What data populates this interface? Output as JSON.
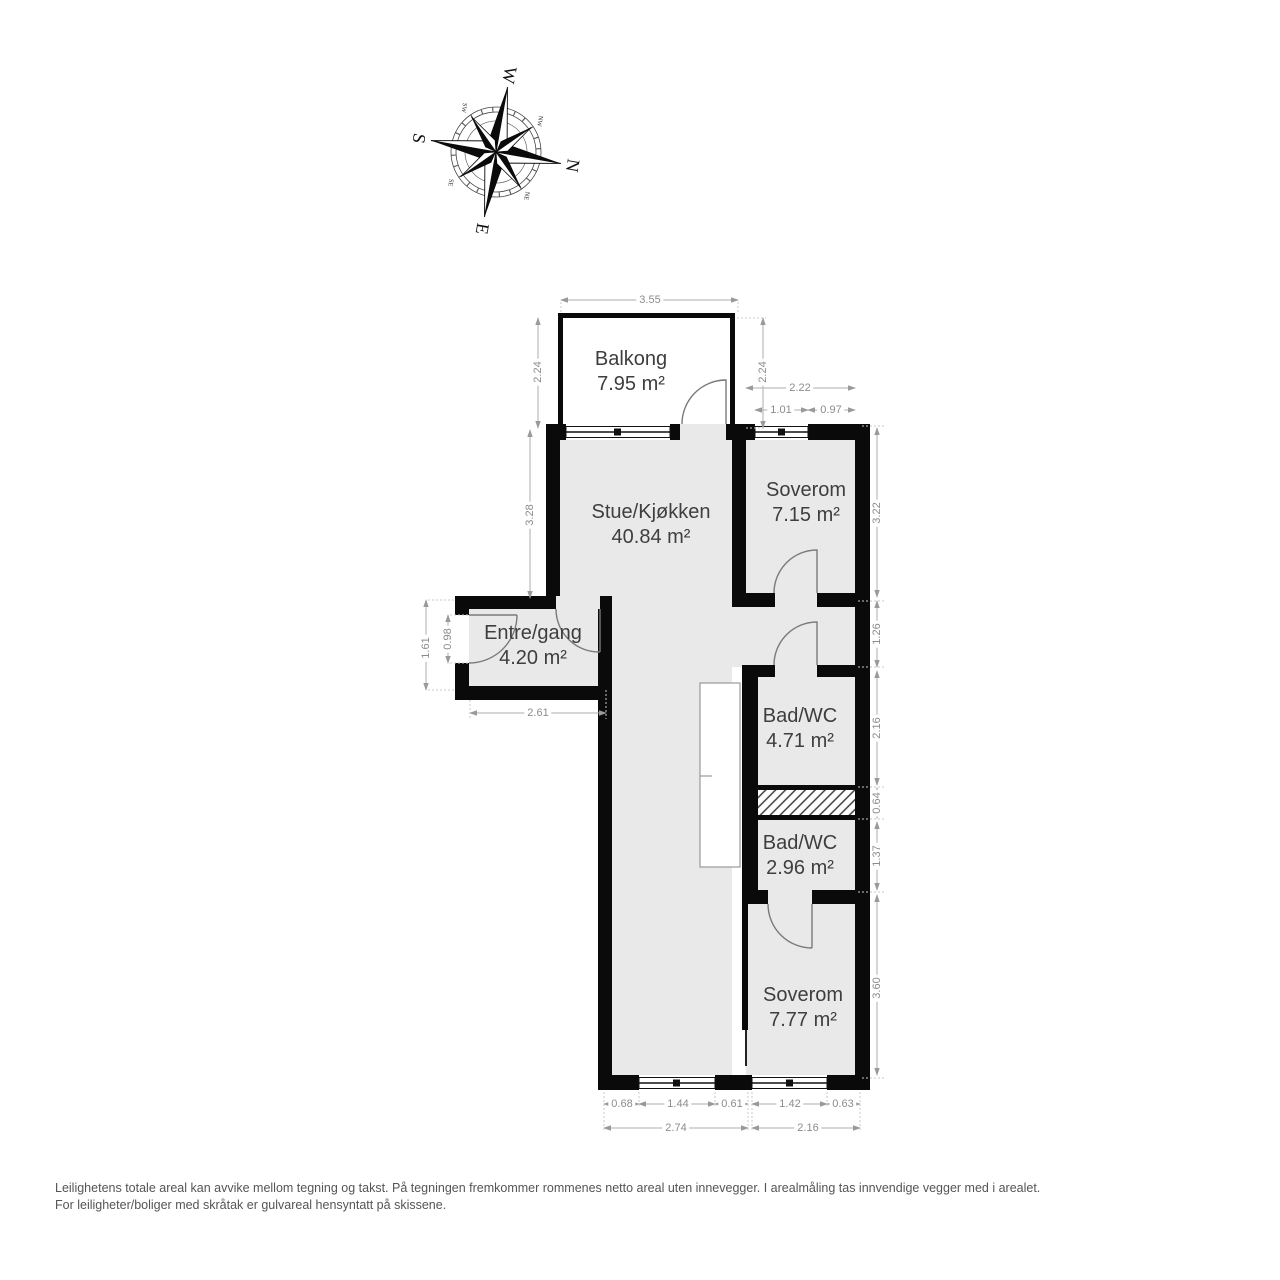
{
  "compass": {
    "n": "N",
    "e": "E",
    "s": "S",
    "w": "W",
    "ne": "NE",
    "se": "SE",
    "sw": "SW",
    "nw": "NW"
  },
  "rooms": {
    "balcony": {
      "name": "Balkong",
      "area": "7.95 m²"
    },
    "living": {
      "name": "Stue/Kjøkken",
      "area": "40.84 m²"
    },
    "bedroom1": {
      "name": "Soverom",
      "area": "7.15 m²"
    },
    "entre": {
      "name": "Entre/gang",
      "area": "4.20 m²"
    },
    "bath1": {
      "name": "Bad/WC",
      "area": "4.71 m²"
    },
    "bath2": {
      "name": "Bad/WC",
      "area": "2.96 m²"
    },
    "bedroom2": {
      "name": "Soverom",
      "area": "7.77 m²"
    }
  },
  "dims": {
    "balcony_width": "3.55",
    "balcony_depth_left": "2.24",
    "balcony_depth_right": "2.24",
    "bedroom1_width": "2.22",
    "bedroom1_window": "1.01",
    "bedroom1_wall": "0.97",
    "living_left_height": "3.28",
    "bedroom1_depth": "3.22",
    "hall_depth": "1.26",
    "bath1_depth": "2.16",
    "shaft_depth": "0.64",
    "bath2_depth": "1.37",
    "bedroom2_depth": "3.60",
    "entre_outer_left": "1.61",
    "entre_door": "0.98",
    "entre_width": "2.61",
    "bottom_seg1": "0.68",
    "bottom_seg2": "1.44",
    "bottom_seg3": "0.61",
    "bottom_seg4": "1.42",
    "bottom_seg5": "0.63",
    "bottom_total_left": "2.74",
    "bottom_total_right": "2.16"
  },
  "colors": {
    "floor": "#e9e9e9",
    "wall": "#000000",
    "dim_text": "#8c8c8c",
    "room_text": "#3e3e3e"
  },
  "footer": {
    "line1": "Leilighetens totale areal kan avvike mellom tegning og takst. På tegningen fremkommer rommenes netto areal uten innevegger. I arealmåling tas innvendige vegger med i arealet.",
    "line2": "For leiligheter/boliger med skråtak er gulvareal hensyntatt på skissene."
  }
}
